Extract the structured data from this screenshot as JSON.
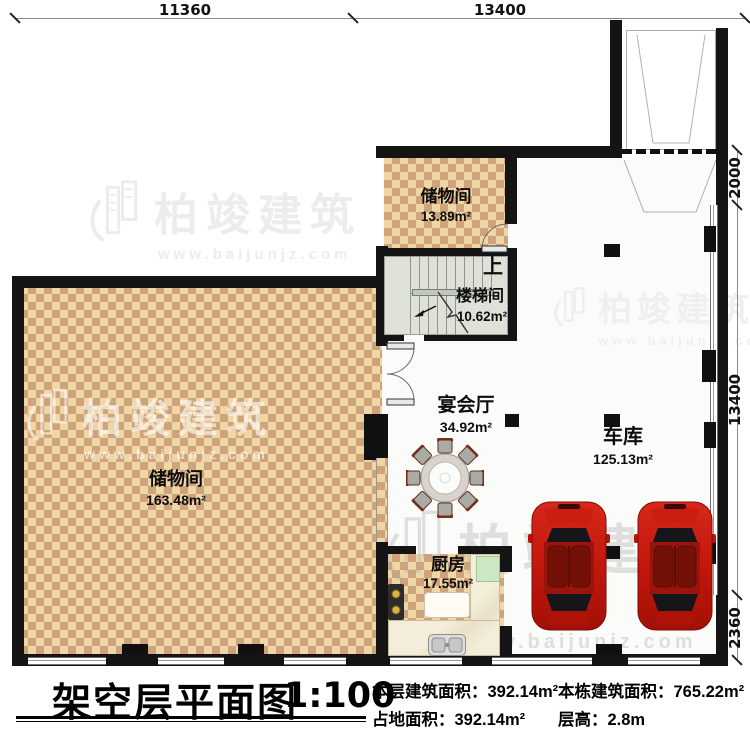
{
  "title": {
    "text": "架空层平面图",
    "scale": "1:100"
  },
  "dimensions": {
    "top": {
      "d1": "11360",
      "d2": "13400"
    },
    "right": {
      "d1": "2000",
      "d2": "13400",
      "d3": "2360"
    }
  },
  "rooms": {
    "storage_top": {
      "name": "储物间",
      "area": "13.89m²"
    },
    "stairwell": {
      "name": "楼梯间",
      "area": "10.62m²",
      "up_label": "上"
    },
    "banquet": {
      "name": "宴会厅",
      "area": "34.92m²"
    },
    "garage": {
      "name": "车库",
      "area": "125.13m²"
    },
    "storage_left": {
      "name": "储物间",
      "area": "163.48m²"
    },
    "kitchen": {
      "name": "厨房",
      "area": "17.55m²"
    }
  },
  "footer": {
    "stats": {
      "floor_area": {
        "label": "本层建筑面积：",
        "value": "392.14m²"
      },
      "land_area": {
        "label": "占地面积：",
        "value": "392.14m²"
      },
      "building_area": {
        "label": "本栋建筑面积：",
        "value": "765.22m²"
      },
      "floor_height": {
        "label": "层高：",
        "value": "2.8m"
      }
    }
  },
  "watermark": {
    "brand": "柏竣建筑",
    "url": "www.baijunjz.com"
  },
  "colors": {
    "wall": "#141414",
    "checker_light": "#eed7a4",
    "checker_dark": "#cfa47c",
    "stair_floor": "#dde1d7",
    "car_red": "#c2170d",
    "counter_marble": "#f3edda",
    "cutting_board_green": "#cde8c4"
  }
}
